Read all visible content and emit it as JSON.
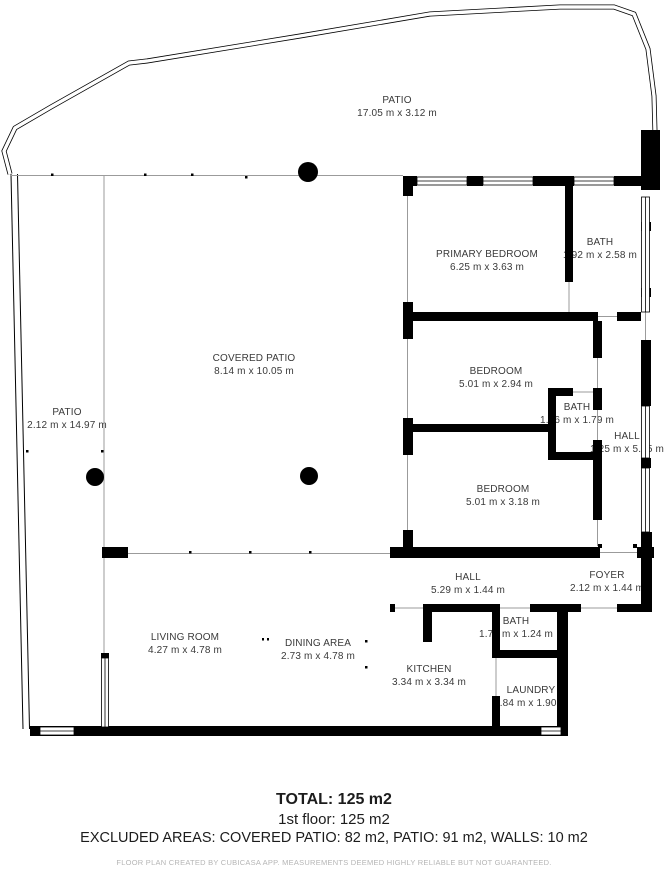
{
  "plan": {
    "rooms": [
      {
        "id": "patio-top",
        "name": "PATIO",
        "dims": "17.05 m x 3.12 m"
      },
      {
        "id": "patio-left",
        "name": "PATIO",
        "dims": "2.12 m x 14.97 m"
      },
      {
        "id": "covered-patio",
        "name": "COVERED PATIO",
        "dims": "8.14 m x 10.05 m"
      },
      {
        "id": "primary-bedroom",
        "name": "PRIMARY BEDROOM",
        "dims": "6.25 m x 3.63 m"
      },
      {
        "id": "bath-ensuite",
        "name": "BATH",
        "dims": "1.92 m x 2.58 m"
      },
      {
        "id": "bedroom-mid",
        "name": "BEDROOM",
        "dims": "5.01 m x 2.94 m"
      },
      {
        "id": "bath-mid",
        "name": "BATH",
        "dims": "1.16 m x 1.79 m"
      },
      {
        "id": "hall-right",
        "name": "HALL",
        "dims": "1.25 m x 5.65 m"
      },
      {
        "id": "bedroom-low",
        "name": "BEDROOM",
        "dims": "5.01 m x 3.18 m"
      },
      {
        "id": "hall-bottom",
        "name": "HALL",
        "dims": "5.29 m x 1.44 m"
      },
      {
        "id": "foyer",
        "name": "FOYER",
        "dims": "2.12 m x 1.44 m"
      },
      {
        "id": "living-room",
        "name": "LIVING ROOM",
        "dims": "4.27 m x 4.78 m"
      },
      {
        "id": "dining-area",
        "name": "DINING AREA",
        "dims": "2.73 m x 4.78 m"
      },
      {
        "id": "kitchen",
        "name": "KITCHEN",
        "dims": "3.34 m x 3.34 m"
      },
      {
        "id": "bath-guest",
        "name": "BATH",
        "dims": "1.78 m x 1.24 m"
      },
      {
        "id": "laundry",
        "name": "LAUNDRY",
        "dims": "1.84 m x 1.90 m"
      }
    ]
  },
  "summary": {
    "total": "TOTAL: 125 m2",
    "floor": "1st floor: 125 m2",
    "excluded": "EXCLUDED AREAS: COVERED PATIO: 82 m2, PATIO: 91 m2, WALLS: 10 m2"
  },
  "footer": "FLOOR PLAN CREATED BY CUBICASA APP. MEASUREMENTS DEEMED HIGHLY RELIABLE BUT NOT GUARANTEED.",
  "colors": {
    "wall": "#000000",
    "line": "#9b9b9b",
    "label": "#3a3a3a",
    "footer": "#b5b5b5"
  }
}
